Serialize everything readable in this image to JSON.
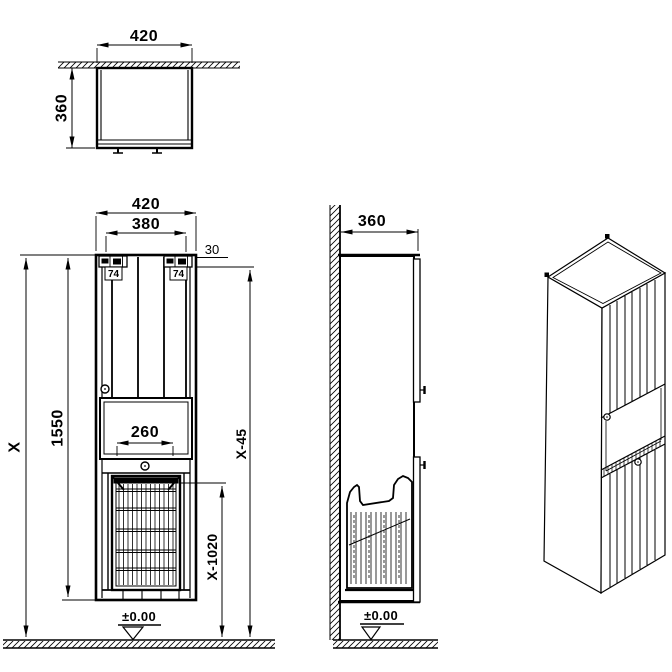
{
  "colors": {
    "line": "#000000",
    "background": "#ffffff"
  },
  "views": {
    "top_view": {
      "dims": {
        "width": "420",
        "depth": "360"
      }
    },
    "front_view": {
      "dims": {
        "width": "420",
        "inner_width": "380",
        "top_gap": "30",
        "hanger_left": "74",
        "hanger_right": "74",
        "cabinet_height": "1550",
        "overall_height": "X",
        "niche_width": "260",
        "door_top_height": "X-45",
        "basket_rim_height": "X-1020",
        "floor_datum": "±0.00"
      }
    },
    "side_view": {
      "dims": {
        "depth": "360",
        "floor_datum": "±0.00"
      }
    }
  }
}
